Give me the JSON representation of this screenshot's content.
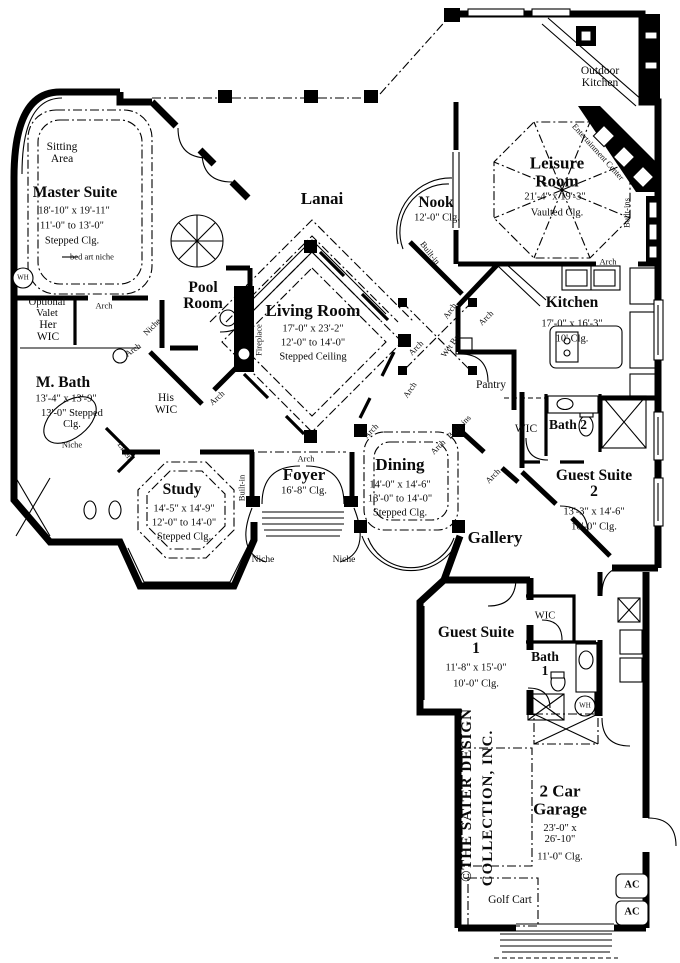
{
  "rooms": {
    "lanai": {
      "name": "Lanai"
    },
    "sitting_area": {
      "name": "Sitting Area"
    },
    "master_suite": {
      "name": "Master Suite",
      "dim1": "18'-10\" x 19'-11\"",
      "dim2": "11'-0\" to 13'-0\"",
      "dim3": "Stepped Clg."
    },
    "pool_room": {
      "name": "Pool Room"
    },
    "living_room": {
      "name": "Living Room",
      "dim1": "17'-0\" x 23'-2\"",
      "dim2": "12'-0\" to 14'-0\"",
      "dim3": "Stepped Ceiling"
    },
    "nook": {
      "name": "Nook",
      "dim1": "12'-0\" Clg."
    },
    "leisure_room": {
      "name": "Leisure Room",
      "dim1": "21'-4\" x 19'-3\"",
      "dim2": "Vaulted Clg."
    },
    "outdoor_kitchen": {
      "name": "Outdoor Kitchen"
    },
    "kitchen": {
      "name": "Kitchen",
      "dim1": "17'-0\" x 16'-3\"",
      "dim2": "10' Clg."
    },
    "pantry": {
      "name": "Pantry"
    },
    "master_bath": {
      "name": "M. Bath",
      "dim1": "13'-4\" x 13'-9\"",
      "dim2": "13'-0\" Stepped Clg."
    },
    "optional_valet": {
      "name": "Optional Valet"
    },
    "her_wic": {
      "name": "Her WIC"
    },
    "his_wic": {
      "name": "His WIC"
    },
    "study": {
      "name": "Study",
      "dim1": "14'-5\" x 14'-9\"",
      "dim2": "12'-0\" to 14'-0\"",
      "dim3": "Stepped Clg."
    },
    "foyer": {
      "name": "Foyer",
      "dim1": "16'-8\" Clg."
    },
    "dining": {
      "name": "Dining",
      "dim1": "14'-0\" x 14'-6\"",
      "dim2": "13'-0\" to 14'-0\"",
      "dim3": "Stepped Clg."
    },
    "gallery": {
      "name": "Gallery"
    },
    "wic_bath2": {
      "name": "WIC"
    },
    "bath2": {
      "name": "Bath 2"
    },
    "guest_suite2": {
      "name": "Guest Suite 2",
      "dim1": "13'-3\" x 14'-6\"",
      "dim2": "10'-0\" Clg."
    },
    "guest_suite1": {
      "name": "Guest Suite 1",
      "dim1": "11'-8\" x 15'-0\"",
      "dim2": "10'-0\" Clg."
    },
    "wic_guest1": {
      "name": "WIC"
    },
    "bath1": {
      "name": "Bath 1"
    },
    "garage": {
      "name": "2 Car Garage",
      "dim1": "23'-0\" x 26'-10\"",
      "dim2": "11'-0\" Clg."
    },
    "golf_cart": {
      "name": "Golf Cart"
    }
  },
  "ann": {
    "arch": "Arch",
    "niche": "Niche",
    "built_in": "Built-in",
    "built_ins": "Built-ins",
    "wet_bar": "Wet Bar",
    "fireplace": "Fireplace",
    "linen": "Linen",
    "entertainment_center": "Entertainment Center",
    "bed_art_niche": "bed art niche",
    "wh": "WH",
    "ac": "AC"
  },
  "copyright": {
    "line1": "©THE SATER DESIGN",
    "line2": "COLLECTION, INC."
  },
  "colors": {
    "ink": "#000000",
    "paper": "#ffffff"
  }
}
